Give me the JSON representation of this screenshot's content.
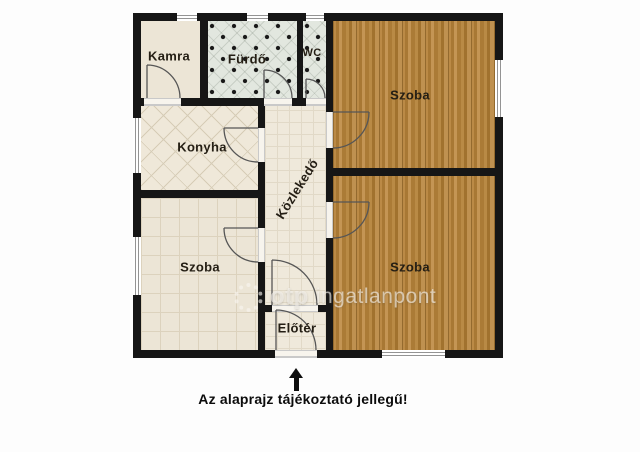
{
  "floorplan": {
    "rooms": [
      {
        "id": "kamra",
        "label": "Kamra"
      },
      {
        "id": "furdo",
        "label": "Fürdő"
      },
      {
        "id": "wc",
        "label": "WC"
      },
      {
        "id": "szoba-top-right",
        "label": "Szoba"
      },
      {
        "id": "szoba-bottom-right",
        "label": "Szoba"
      },
      {
        "id": "konyha",
        "label": "Konyha"
      },
      {
        "id": "kozlekedo",
        "label": "Közlekedő"
      },
      {
        "id": "szoba-bottom-left",
        "label": "Szoba"
      },
      {
        "id": "eloter",
        "label": "Előtér"
      }
    ],
    "caption": "Az alaprajz tájékoztató jellegű!",
    "watermark": {
      "brand": "otp",
      "name": "ingatlanpont"
    },
    "colors": {
      "wall": "#161616",
      "wood_floor": "#b3823f",
      "bath_tile": "#e2e7df",
      "cream_floor": "#ece5d6",
      "background": "#fdfdfd"
    }
  }
}
